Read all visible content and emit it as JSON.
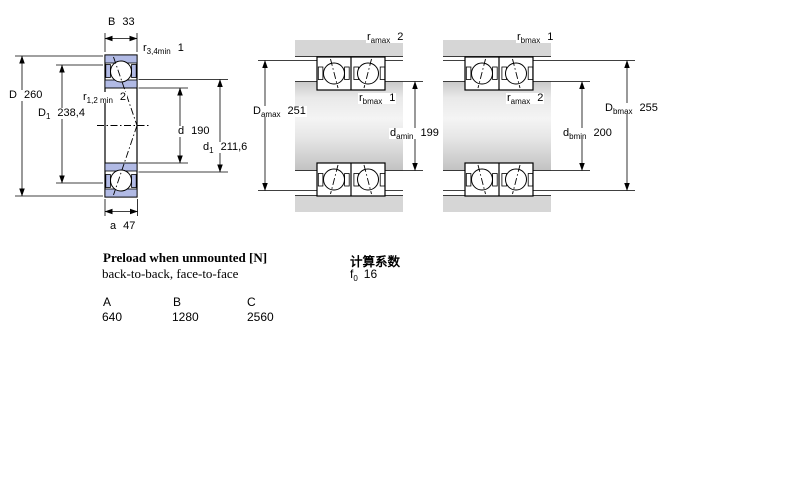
{
  "colors": {
    "line": "#000000",
    "ring_blue": "#b1bae5",
    "housing_gray": "#d6d6d6"
  },
  "left": {
    "B": {
      "sym": "B",
      "sub": "",
      "val": "33"
    },
    "r34": {
      "sym": "r",
      "sub": "3,4min",
      "val": "1"
    },
    "D": {
      "sym": "D",
      "sub": "",
      "val": "260"
    },
    "D1": {
      "sym": "D",
      "sub": "1",
      "val": "238,4"
    },
    "r12": {
      "sym": "r",
      "sub": "1,2 min",
      "val": "2"
    },
    "d": {
      "sym": "d",
      "sub": "",
      "val": "190"
    },
    "d1": {
      "sym": "d",
      "sub": "1",
      "val": "211,6"
    },
    "a": {
      "sym": "a",
      "sub": "",
      "val": "47"
    }
  },
  "middle": {
    "r_top": {
      "sym": "r",
      "sub": "amax",
      "val": "2"
    },
    "r_mid": {
      "sym": "r",
      "sub": "bmax",
      "val": "1"
    },
    "D_side": {
      "sym": "D",
      "sub": "amax",
      "val": "251"
    },
    "d_mid": {
      "sym": "d",
      "sub": "amin",
      "val": "199"
    }
  },
  "right": {
    "r_top": {
      "sym": "r",
      "sub": "bmax",
      "val": "1"
    },
    "r_mid": {
      "sym": "r",
      "sub": "amax",
      "val": "2"
    },
    "D_side": {
      "sym": "D",
      "sub": "bmax",
      "val": "255"
    },
    "d_mid": {
      "sym": "d",
      "sub": "bmin",
      "val": "200"
    }
  },
  "preload": {
    "title": "Preload when unmounted [N]",
    "subtitle": "back-to-back, face-to-face",
    "columns": [
      "A",
      "B",
      "C"
    ],
    "values": [
      "640",
      "1280",
      "2560"
    ]
  },
  "factors": {
    "title": "计算系数",
    "f0": {
      "sym": "f",
      "sub": "0",
      "val": "16"
    }
  }
}
